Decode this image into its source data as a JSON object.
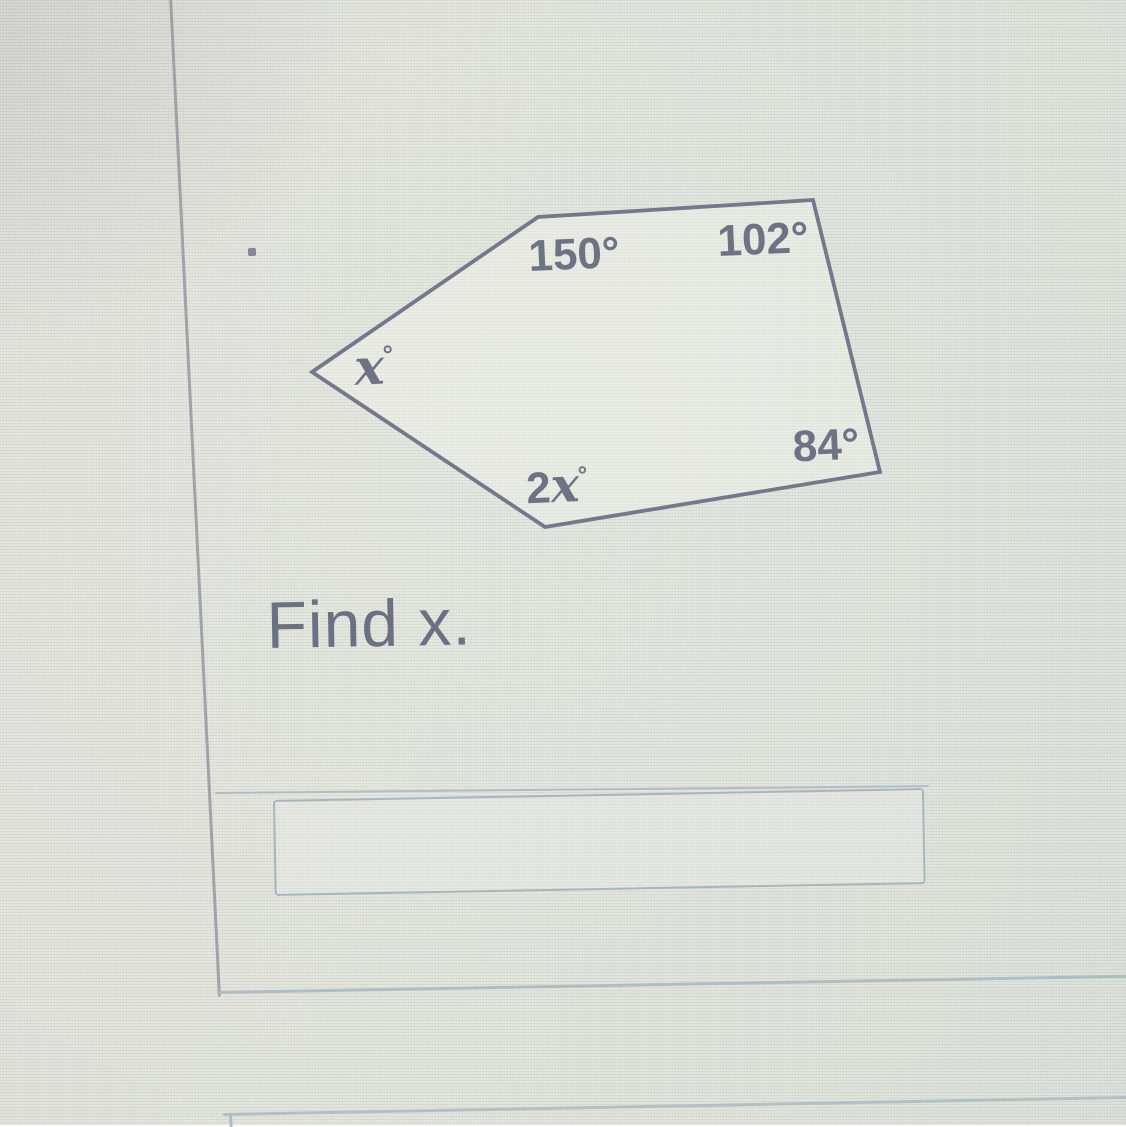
{
  "scene": {
    "kind": "photo of a math quiz question on a screen",
    "colors": {
      "background": "#e1e3dc",
      "diagram_ink": "#73788a",
      "label_text": "#6e7384",
      "instruction_text": "#6a7282",
      "input_border": "#a6b6be",
      "page_rule": "#90939e"
    }
  },
  "question": {
    "instruction": "Find x.",
    "bullet_icon": "dot"
  },
  "diagram": {
    "type": "pentagon-angle-diagram",
    "shape": "irregular pentagon",
    "labels": [
      {
        "id": "top-left",
        "text": "150°"
      },
      {
        "id": "top-right",
        "text": "102°"
      },
      {
        "id": "left",
        "var": "x",
        "deg": "°"
      },
      {
        "id": "bottom-right",
        "text": "84°"
      },
      {
        "id": "bottom",
        "coef": "2",
        "var": "x",
        "deg": "°"
      }
    ]
  },
  "answer": {
    "value": ""
  }
}
